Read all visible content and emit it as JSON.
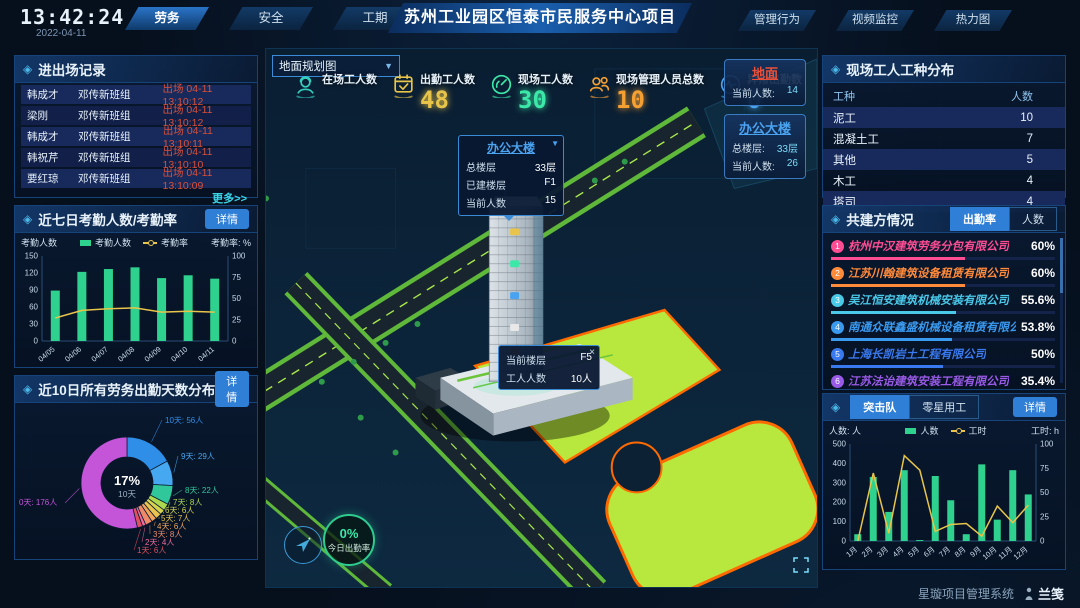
{
  "ui": {
    "detail_label": "详情"
  },
  "topbar": {
    "time": "13:42:24",
    "date": "2022-04-11",
    "title": "苏州工业园区恒泰市民服务中心项目",
    "nav_left": [
      {
        "label": "劳务",
        "active": true
      },
      {
        "label": "安全",
        "active": false
      },
      {
        "label": "工期",
        "active": false
      }
    ],
    "nav_right": [
      {
        "label": "管理行为"
      },
      {
        "label": "视频监控"
      },
      {
        "label": "热力图"
      }
    ]
  },
  "entry_exit": {
    "title": "进出场记录",
    "more_label": "更多>>",
    "event_color": "#d8503a",
    "rows": [
      {
        "name": "韩成才",
        "team": "邓传新班组",
        "event": "出场 04-11 13:10:12"
      },
      {
        "name": "梁刚",
        "team": "邓传新班组",
        "event": "出场 04-11 13:10:12"
      },
      {
        "name": "韩成才",
        "team": "邓传新班组",
        "event": "出场 04-11 13:10:11"
      },
      {
        "name": "韩祝芹",
        "team": "邓传新班组",
        "event": "出场 04-11 13:10:10"
      },
      {
        "name": "要红琼",
        "team": "邓传新班组",
        "event": "出场 04-11 13:10:09"
      }
    ]
  },
  "map": {
    "view_select": "地面规划图",
    "stats": [
      {
        "label": "在场工人数",
        "value": "",
        "icon": "worker-icon",
        "color": "#35cfc0"
      },
      {
        "label": "出勤工人数",
        "value": "48",
        "icon": "calendar-check-icon",
        "color": "#e8c44a"
      },
      {
        "label": "现场工人数",
        "value": "30",
        "icon": "gauge-icon",
        "color": "#3ce8a8"
      },
      {
        "label": "现场管理人员总数",
        "value": "10",
        "icon": "people-icon",
        "color": "#f5a033"
      },
      {
        "label": "异常出勤数",
        "value": "0",
        "icon": "pulse-icon",
        "color": "#4aa3f0"
      }
    ],
    "building_popup": {
      "title": "办公大楼",
      "rows": [
        {
          "label": "总楼层",
          "value": "33层"
        },
        {
          "label": "已建楼层",
          "value": "F1"
        },
        {
          "label": "当前人数",
          "value": "15"
        }
      ]
    },
    "floor_popup": {
      "close": "×",
      "rows": [
        {
          "label": "当前楼层",
          "value": "F5"
        },
        {
          "label": "工人人数",
          "value": "10人"
        }
      ]
    },
    "zone_cards": [
      {
        "title": "地面",
        "color": "#e8503a",
        "rows": [
          {
            "label": "当前人数:",
            "value": "14"
          }
        ]
      },
      {
        "title": "办公大楼",
        "color": "#4aa3f0",
        "rows": [
          {
            "label": "总楼层:",
            "value": "33层"
          },
          {
            "label": "当前人数:",
            "value": "26"
          }
        ]
      }
    ],
    "attendance_badge": {
      "value": "0%",
      "label": "今日出勤率"
    }
  },
  "worker_types": {
    "title": "现场工人工种分布",
    "headers": [
      "工种",
      "人数"
    ],
    "rows": [
      {
        "type": "泥工",
        "count": "10"
      },
      {
        "type": "混凝土工",
        "count": "7"
      },
      {
        "type": "其他",
        "count": "5"
      },
      {
        "type": "木工",
        "count": "4"
      },
      {
        "type": "塔司",
        "count": "4"
      }
    ]
  },
  "partners": {
    "title": "共建方情况",
    "tabs": [
      {
        "label": "出勤率",
        "active": true
      },
      {
        "label": "人数",
        "active": false
      }
    ],
    "rows": [
      {
        "rank": "1",
        "name": "杭州中汉建筑劳务分包有限公司",
        "value": "60%",
        "pct": 60,
        "color": "#ff4d94"
      },
      {
        "rank": "2",
        "name": "江苏川翰建筑设备租赁有限公司",
        "value": "60%",
        "pct": 60,
        "color": "#ff8a3a"
      },
      {
        "rank": "3",
        "name": "吴江恒安建筑机械安装有限公司",
        "value": "55.6%",
        "pct": 55.6,
        "color": "#4ac8e8"
      },
      {
        "rank": "4",
        "name": "南通众联鑫盛机械设备租赁有限公司",
        "value": "53.8%",
        "pct": 53.8,
        "color": "#3a9af0"
      },
      {
        "rank": "5",
        "name": "上海长凯岩土工程有限公司",
        "value": "50%",
        "pct": 50,
        "color": "#3a7af0"
      },
      {
        "rank": "6",
        "name": "江苏法诒建筑安装工程有限公司",
        "value": "35.4%",
        "pct": 35.4,
        "color": "#9a5ae8"
      }
    ]
  },
  "task_force": {
    "tabs": [
      {
        "label": "突击队",
        "active": true
      },
      {
        "label": "零星用工",
        "active": false
      }
    ]
  },
  "footer": {
    "system_name": "星璇项目管理系统",
    "logo": "兰笺"
  },
  "chart_data": [
    {
      "id": "weekly-attendance",
      "type": "bar",
      "title": "近七日考勤人数/考勤率",
      "categories": [
        "04/05",
        "04/06",
        "04/07",
        "04/08",
        "04/09",
        "04/10",
        "04/11"
      ],
      "series": [
        {
          "name": "考勤人数",
          "type": "bar",
          "axis": "left",
          "color": "#2fd18e",
          "values": [
            89,
            122,
            127,
            130,
            111,
            116,
            110
          ]
        },
        {
          "name": "考勤率",
          "type": "line",
          "axis": "right",
          "color": "#e8c44a",
          "values": [
            27,
            36,
            38,
            39,
            34,
            35,
            34
          ]
        }
      ],
      "left_axis": {
        "label": "考勤人数",
        "min": 0,
        "max": 150,
        "ticks": [
          0,
          30,
          60,
          90,
          120,
          150
        ]
      },
      "right_axis": {
        "label": "考勤率: %",
        "min": 0,
        "max": 100,
        "ticks": [
          0,
          25,
          50,
          75,
          100
        ]
      },
      "legend_position": "top",
      "grid": false
    },
    {
      "id": "ten-day-attendance-distribution",
      "type": "pie",
      "title": "近10日所有劳务出勤天数分布",
      "center": {
        "pct": "17%",
        "label": "10天"
      },
      "unit": "人",
      "slices": [
        {
          "label": "10天",
          "people": 56,
          "color": "#2f8fe8"
        },
        {
          "label": "9天",
          "people": 29,
          "color": "#45a8f0"
        },
        {
          "label": "8天",
          "people": 22,
          "color": "#30c89a"
        },
        {
          "label": "7天",
          "people": 8,
          "color": "#aed84e"
        },
        {
          "label": "6天",
          "people": 6,
          "color": "#d6d44e"
        },
        {
          "label": "5天",
          "people": 7,
          "color": "#e8c44e"
        },
        {
          "label": "4天",
          "people": 6,
          "color": "#f0a45a"
        },
        {
          "label": "3天",
          "people": 8,
          "color": "#ee8a6a"
        },
        {
          "label": "2天",
          "people": 4,
          "color": "#f06a9a"
        },
        {
          "label": "1天",
          "people": 6,
          "color": "#e05060"
        },
        {
          "label": "0天",
          "people": 176,
          "color": "#c455d8"
        }
      ]
    },
    {
      "id": "task-force-monthly",
      "type": "bar",
      "title": "突击队",
      "categories": [
        "1月",
        "2月",
        "3月",
        "4月",
        "5月",
        "6月",
        "7月",
        "8月",
        "9月",
        "10月",
        "11月",
        "12月"
      ],
      "series": [
        {
          "name": "人数",
          "type": "bar",
          "axis": "left",
          "color": "#2fd18e",
          "values": [
            35,
            330,
            150,
            365,
            5,
            335,
            210,
            35,
            395,
            110,
            365,
            240
          ]
        },
        {
          "name": "工时",
          "type": "line",
          "axis": "right",
          "color": "#e8c44a",
          "values": [
            0,
            70,
            8,
            88,
            73,
            10,
            17,
            18,
            5,
            36,
            19,
            37
          ]
        }
      ],
      "left_axis": {
        "label": "人数: 人",
        "min": 0,
        "max": 500,
        "ticks": [
          0,
          100,
          200,
          300,
          400,
          500
        ]
      },
      "right_axis": {
        "label": "工时: h",
        "min": 0,
        "max": 100,
        "ticks": [
          0,
          25,
          50,
          75,
          100
        ]
      },
      "legend_position": "top",
      "grid": false
    }
  ]
}
